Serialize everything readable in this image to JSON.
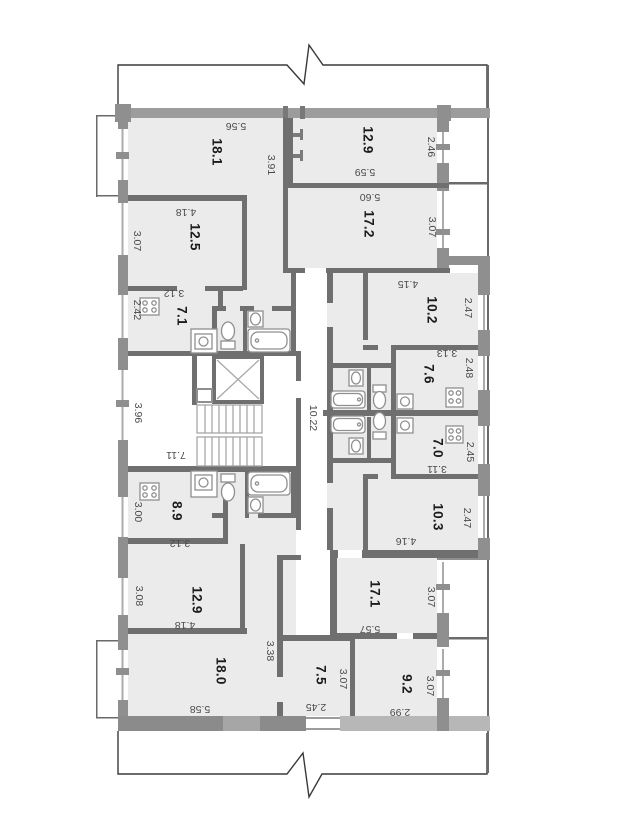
{
  "meta": {
    "drawing_type": "apartment-building floor plan section",
    "units": "meters"
  },
  "colors": {
    "room_fill": "#ebebeb",
    "exterior_wall": "#9c9c9c",
    "wall_pier": "#8f8f8f",
    "interior_wall": "#6f6f6f",
    "light_wall": "#b7b7b7",
    "fixture_stroke": "#8f8f8f",
    "break_line": "#3a3a3a",
    "area_text": "#1b1b1b",
    "dim_text": "#4a4a4a"
  },
  "labels": [
    {
      "kind": "room-area",
      "text": "18.1"
    },
    {
      "kind": "room-area",
      "text": "12.5"
    },
    {
      "kind": "room-area",
      "text": "7.1"
    },
    {
      "kind": "room-area",
      "text": "12.9"
    },
    {
      "kind": "room-area",
      "text": "17.2"
    },
    {
      "kind": "room-area",
      "text": "10.2"
    },
    {
      "kind": "room-area",
      "text": "7.6"
    },
    {
      "kind": "room-area",
      "text": "7.0"
    },
    {
      "kind": "room-area",
      "text": "10.3"
    },
    {
      "kind": "room-area",
      "text": "17.1"
    },
    {
      "kind": "room-area",
      "text": "9.2"
    },
    {
      "kind": "room-area",
      "text": "8.9"
    },
    {
      "kind": "room-area",
      "text": "12.9"
    },
    {
      "kind": "room-area",
      "text": "18.0"
    },
    {
      "kind": "room-area",
      "text": "7.5"
    },
    {
      "kind": "dimension",
      "text": "5.56"
    },
    {
      "kind": "dimension",
      "text": "4.18"
    },
    {
      "kind": "dimension",
      "text": "3.12"
    },
    {
      "kind": "dimension",
      "text": "7.11"
    },
    {
      "kind": "dimension",
      "text": "5.59"
    },
    {
      "kind": "dimension",
      "text": "5.60"
    },
    {
      "kind": "dimension",
      "text": "4.15"
    },
    {
      "kind": "dimension",
      "text": "3.13"
    },
    {
      "kind": "dimension",
      "text": "3.11"
    },
    {
      "kind": "dimension",
      "text": "4.16"
    },
    {
      "kind": "dimension",
      "text": "5.57"
    },
    {
      "kind": "dimension",
      "text": "2.99"
    },
    {
      "kind": "dimension",
      "text": "3.12"
    },
    {
      "kind": "dimension",
      "text": "4.18"
    },
    {
      "kind": "dimension",
      "text": "5.58"
    },
    {
      "kind": "dimension",
      "text": "2.45"
    },
    {
      "kind": "dimension",
      "text": "3.91"
    },
    {
      "kind": "dimension",
      "text": "3.07"
    },
    {
      "kind": "dimension",
      "text": "2.42"
    },
    {
      "kind": "dimension",
      "text": "3.96"
    },
    {
      "kind": "dimension",
      "text": "10.22"
    },
    {
      "kind": "dimension",
      "text": "2.46"
    },
    {
      "kind": "dimension",
      "text": "3.07"
    },
    {
      "kind": "dimension",
      "text": "2.47"
    },
    {
      "kind": "dimension",
      "text": "2.48"
    },
    {
      "kind": "dimension",
      "text": "2.45"
    },
    {
      "kind": "dimension",
      "text": "2.47"
    },
    {
      "kind": "dimension",
      "text": "3.07"
    },
    {
      "kind": "dimension",
      "text": "3.07"
    },
    {
      "kind": "dimension",
      "text": "3.00"
    },
    {
      "kind": "dimension",
      "text": "3.08"
    },
    {
      "kind": "dimension",
      "text": "3.38"
    },
    {
      "kind": "dimension",
      "text": "3.07"
    }
  ]
}
